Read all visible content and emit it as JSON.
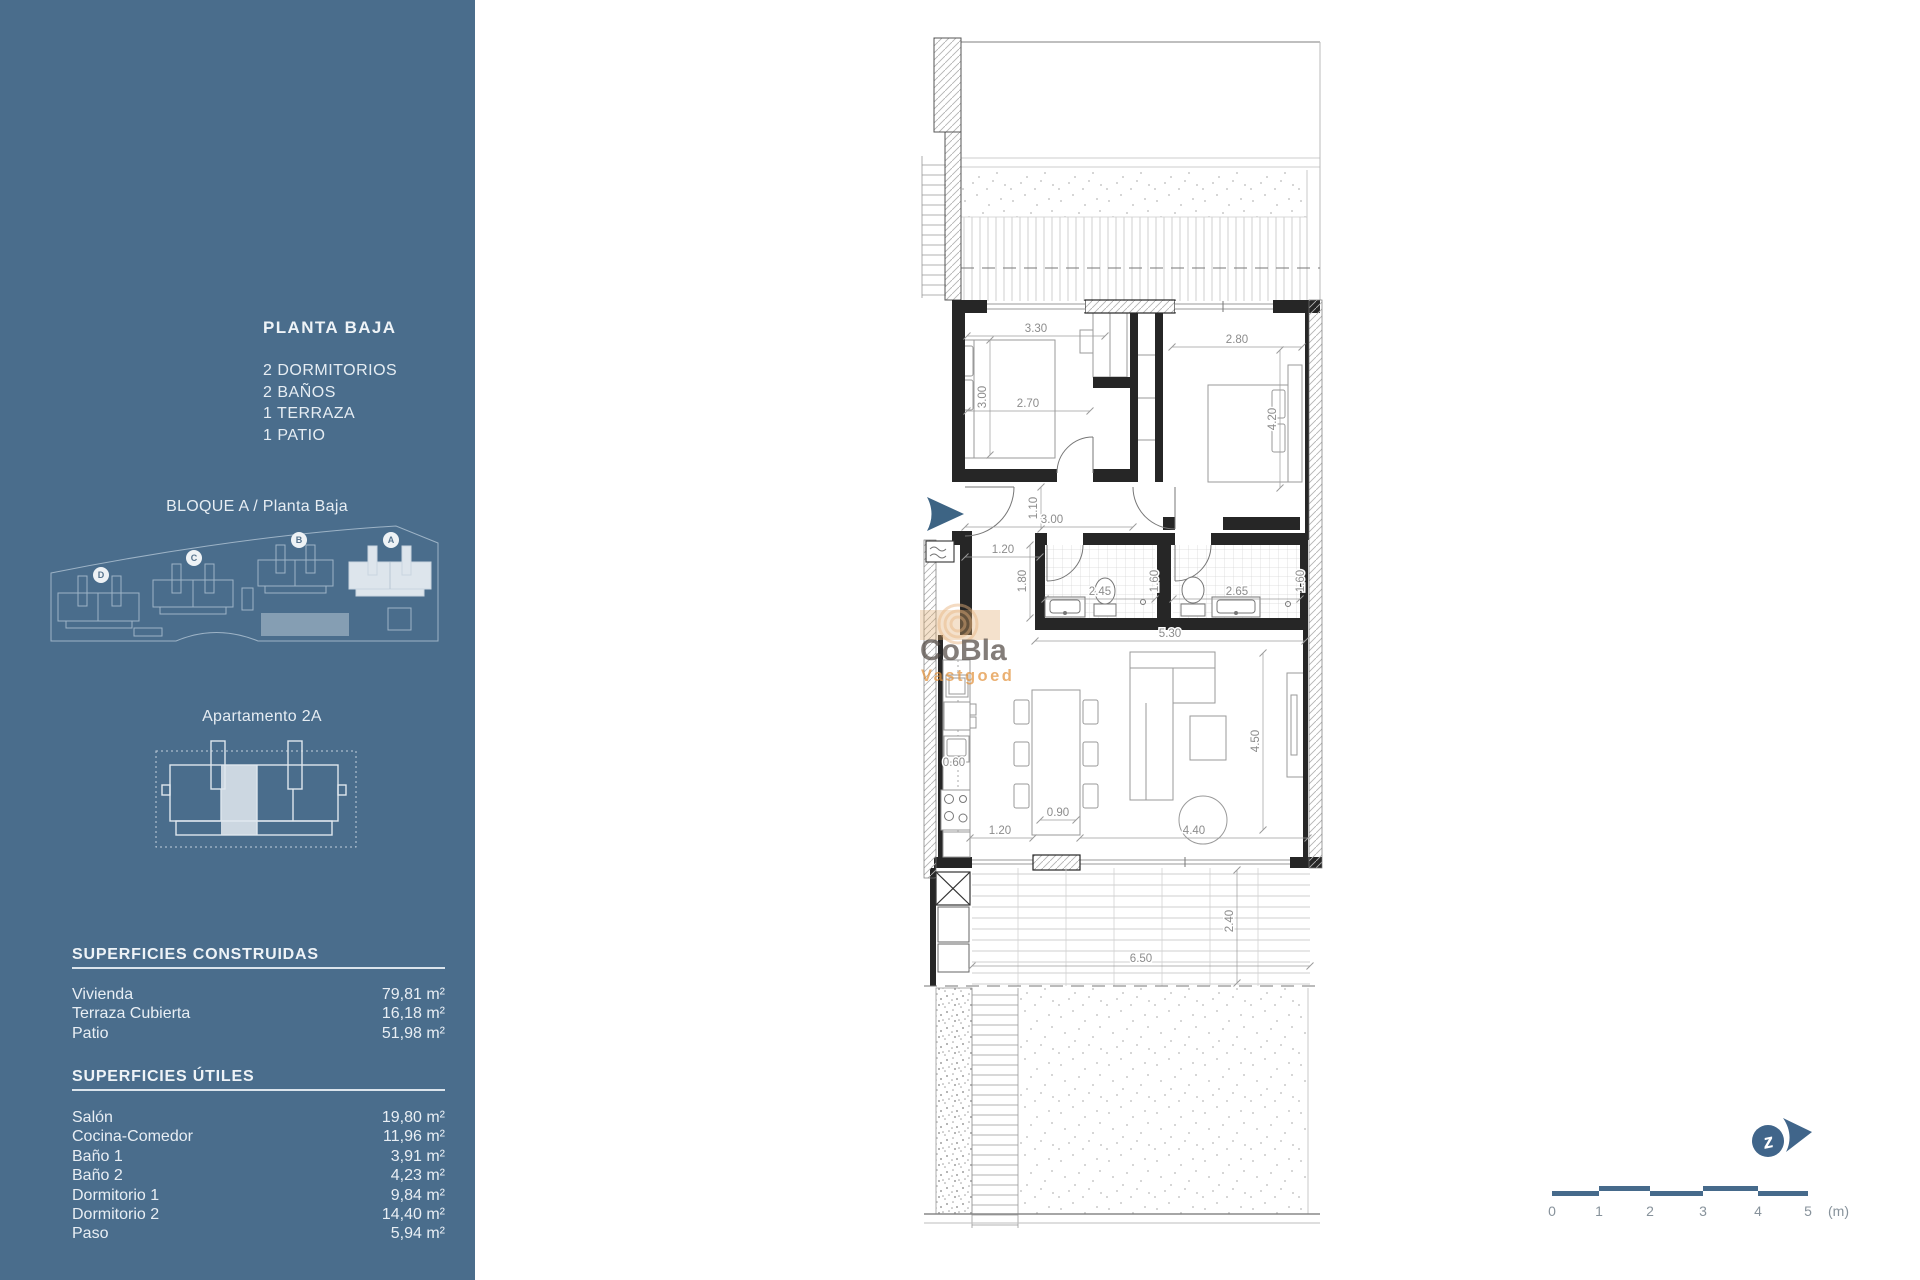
{
  "sidebar": {
    "title": "PLANTA BAJA",
    "features": [
      "2 DORMITORIOS",
      "2 BAÑOS",
      "1 TERRAZA",
      "1 PATIO"
    ],
    "block_label": "BLOQUE A / Planta Baja",
    "site_map": {
      "blocks": [
        {
          "letter": "D",
          "x": 55,
          "y": 57
        },
        {
          "letter": "C",
          "x": 148,
          "y": 40
        },
        {
          "letter": "B",
          "x": 253,
          "y": 22
        },
        {
          "letter": "A",
          "x": 345,
          "y": 22
        }
      ]
    },
    "apartment_label": "Apartamento 2A",
    "superficies_construidas": {
      "title": "SUPERFICIES CONSTRUIDAS",
      "rows": [
        {
          "label": "Vivienda",
          "value": "79,81 m²"
        },
        {
          "label": "Terraza Cubierta",
          "value": "16,18 m²"
        },
        {
          "label": "Patio",
          "value": "51,98 m²"
        }
      ]
    },
    "superficies_utiles": {
      "title": "SUPERFICIES ÚTILES",
      "rows": [
        {
          "label": "Salón",
          "value": "19,80 m²"
        },
        {
          "label": "Cocina-Comedor",
          "value": "11,96 m²"
        },
        {
          "label": "Baño 1",
          "value": "3,91 m²"
        },
        {
          "label": "Baño 2",
          "value": "4,23 m²"
        },
        {
          "label": "Dormitorio 1",
          "value": "9,84 m²"
        },
        {
          "label": "Dormitorio 2",
          "value": "14,40 m²"
        },
        {
          "label": "Paso",
          "value": "5,94 m²"
        }
      ]
    }
  },
  "floor_plan": {
    "dimension_labels": [
      {
        "text": "3.30",
        "x": 1036,
        "y": 332
      },
      {
        "text": "3.00",
        "x": 986,
        "y": 397,
        "rotate": true
      },
      {
        "text": "2.70",
        "x": 1028,
        "y": 407
      },
      {
        "text": "2.80",
        "x": 1237,
        "y": 343
      },
      {
        "text": "4.20",
        "x": 1276,
        "y": 419,
        "rotate": true
      },
      {
        "text": "1.10",
        "x": 1037,
        "y": 508,
        "rotate": true
      },
      {
        "text": "3.00",
        "x": 1052,
        "y": 523
      },
      {
        "text": "1.20",
        "x": 1003,
        "y": 553
      },
      {
        "text": "1.80",
        "x": 1026,
        "y": 581,
        "rotate": true
      },
      {
        "text": "2.45",
        "x": 1100,
        "y": 595
      },
      {
        "text": "1.60",
        "x": 1158,
        "y": 581,
        "rotate": true
      },
      {
        "text": "2.65",
        "x": 1237,
        "y": 595
      },
      {
        "text": "1.60",
        "x": 1304,
        "y": 581,
        "rotate": true
      },
      {
        "text": "5.30",
        "x": 1170,
        "y": 637
      },
      {
        "text": "0.60",
        "x": 954,
        "y": 766
      },
      {
        "text": "4.50",
        "x": 1259,
        "y": 741,
        "rotate": true
      },
      {
        "text": "0.90",
        "x": 1058,
        "y": 816
      },
      {
        "text": "1.20",
        "x": 1000,
        "y": 834
      },
      {
        "text": "4.40",
        "x": 1194,
        "y": 834
      },
      {
        "text": "2.40",
        "x": 1233,
        "y": 921,
        "rotate": true
      },
      {
        "text": "6.50",
        "x": 1141,
        "y": 962
      }
    ]
  },
  "watermark": {
    "line1": "CoBla",
    "line2": "Vastgoed"
  },
  "scale_bar": {
    "labels": [
      {
        "t": "0",
        "x": 1552
      },
      {
        "t": "1",
        "x": 1599
      },
      {
        "t": "2",
        "x": 1650
      },
      {
        "t": "3",
        "x": 1703
      },
      {
        "t": "4",
        "x": 1758
      },
      {
        "t": "5",
        "x": 1808
      }
    ],
    "unit": "(m)",
    "unit_x": 1828
  },
  "colors": {
    "sidebar_bg": "#4a6d8c",
    "accent_blue": "#3d6484",
    "watermark_orange": "#e2923c",
    "dim_text": "#8c8c8c"
  }
}
